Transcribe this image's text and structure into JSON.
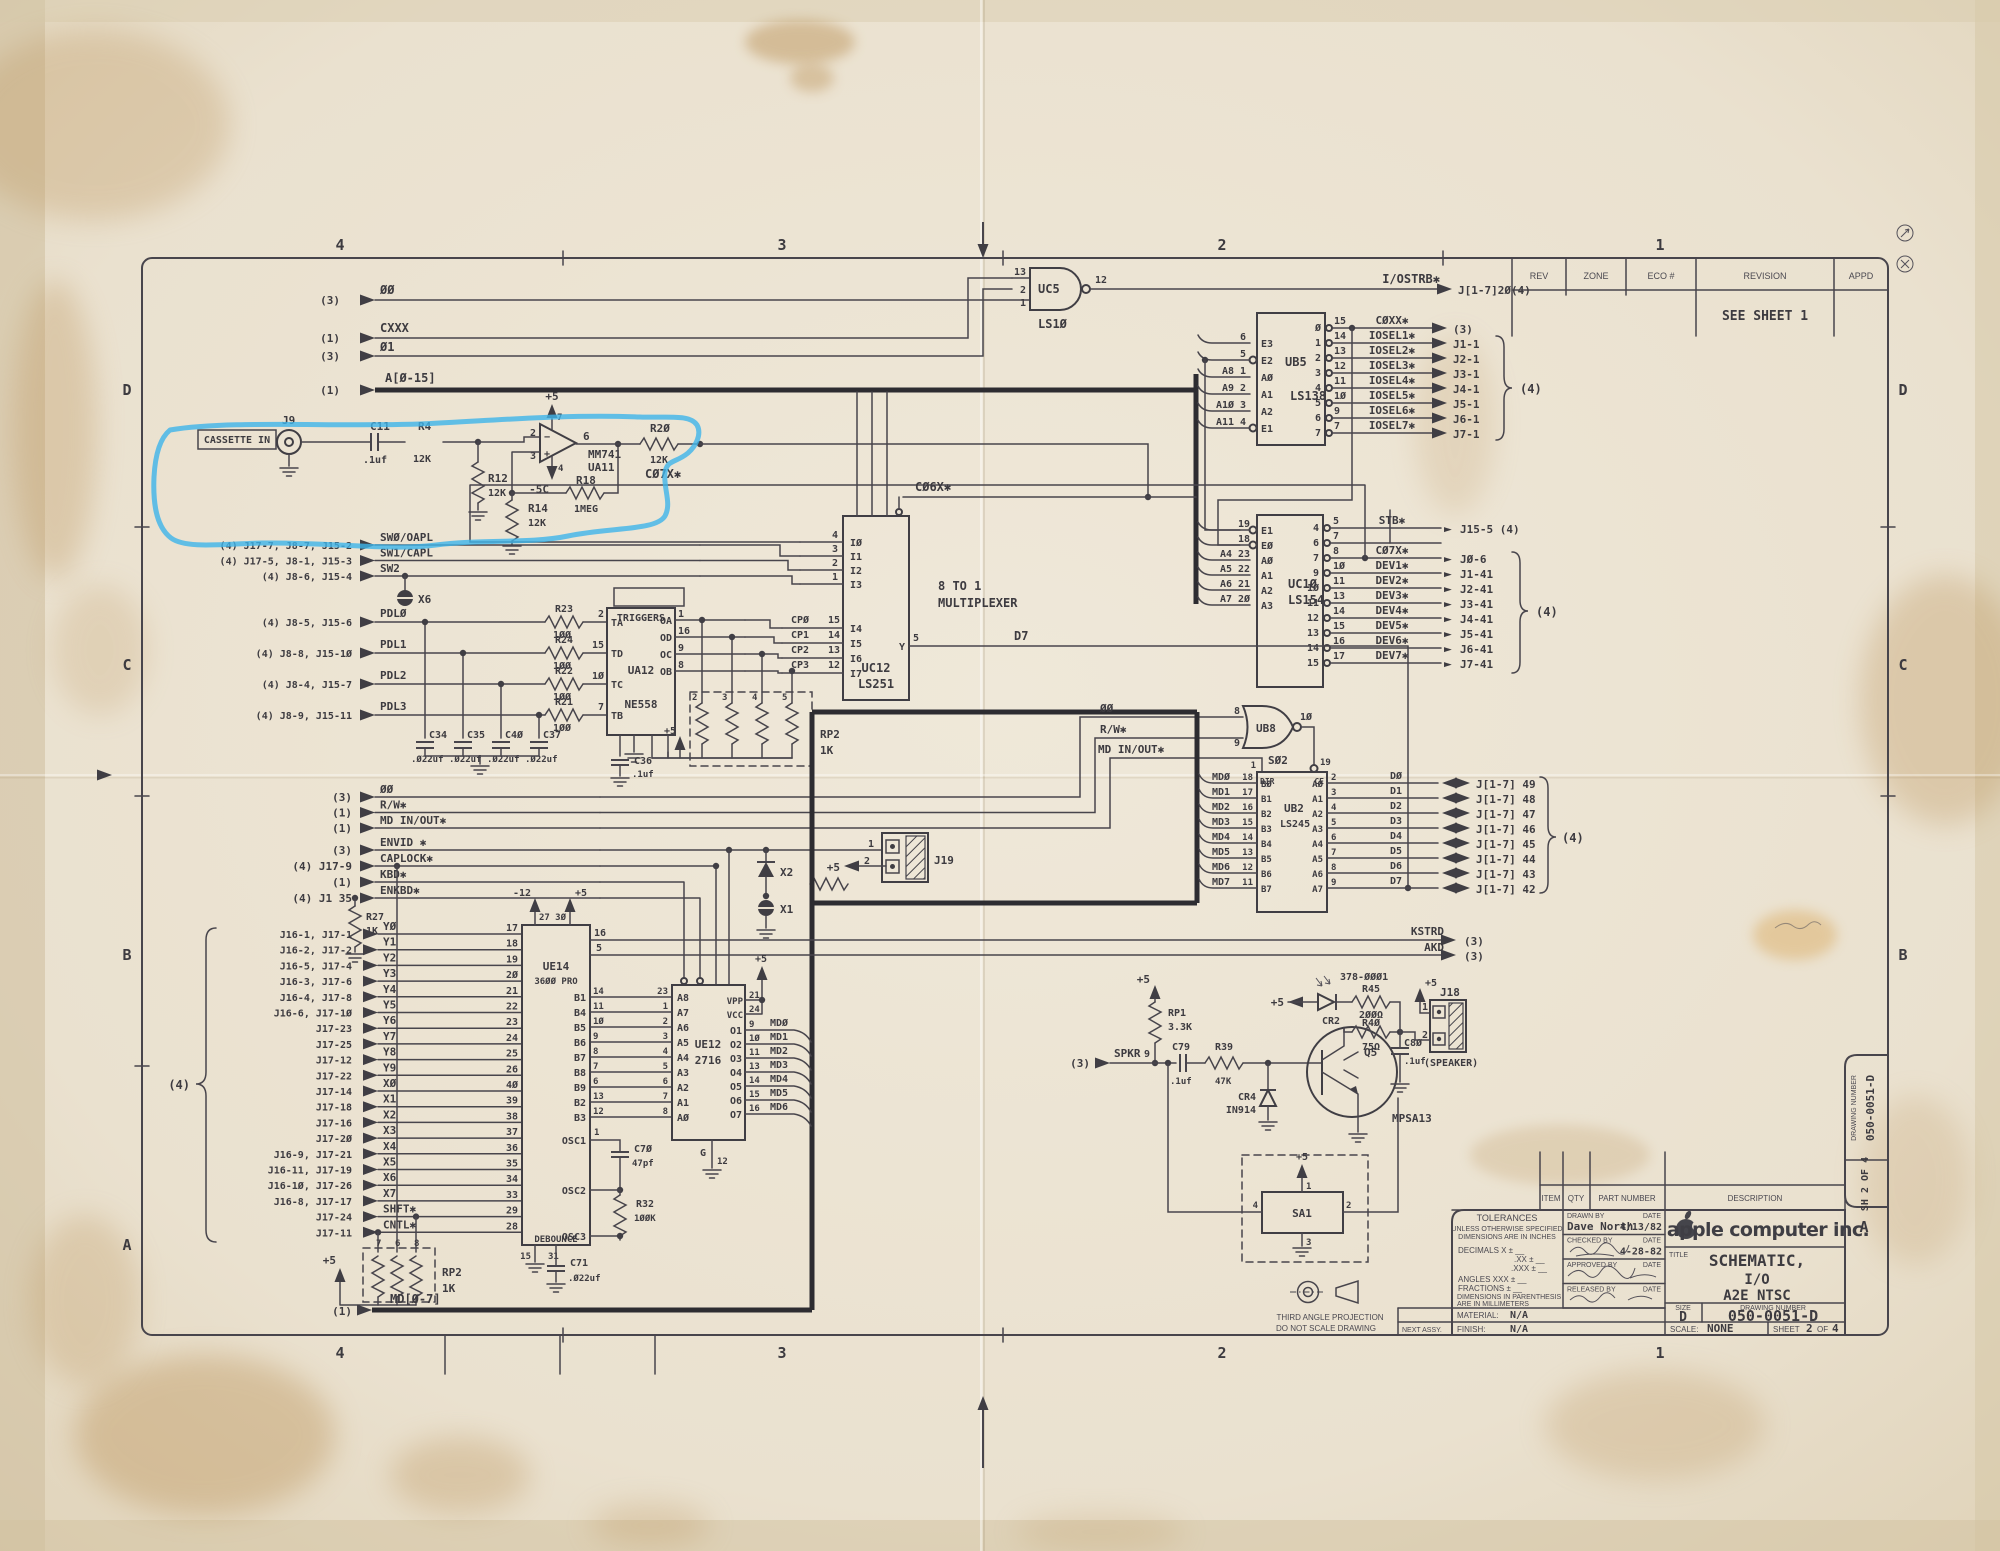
{
  "frame": {
    "zones_top": [
      "4",
      "3",
      "2",
      "1"
    ],
    "zones_bottom": [
      "4",
      "3",
      "2",
      "1"
    ],
    "zones_left": [
      "D",
      "C",
      "B",
      "A"
    ],
    "zones_right": [
      "D",
      "C",
      "B"
    ],
    "zone_a_right": "A",
    "rev_headers": [
      "REV",
      "ZONE",
      "ECO #",
      "REVISION",
      "APPD"
    ],
    "rev_note": "SEE SHEET 1"
  },
  "tb": {
    "parts": [
      "ITEM",
      "QTY",
      "PART NUMBER",
      "DESCRIPTION"
    ],
    "tol1": "TOLERANCES",
    "tol2": "UNLESS OTHERWISE SPECIFIED",
    "tol3": "DIMENSIONS ARE IN INCHES",
    "tol_r1": "DECIMALS       X ±  __",
    "tol_r2": ".XX ±  __",
    "tol_r3": ".XXX ±  __",
    "tol_r4": "ANGLES     XXX ±  __",
    "tol_r5": "FRACTIONS      ±  __",
    "tol_n1": "DIMENSIONS IN PARENTHESIS",
    "tol_n2": "ARE IN MILLIMETERS",
    "sign": [
      {
        "label": "DRAWN BY",
        "dl": "DATE",
        "name": "Dave North",
        "date": "4/13/82"
      },
      {
        "label": "CHECKED BY",
        "dl": "DATE",
        "name": "",
        "date": "4-28-82"
      },
      {
        "label": "APPROVED BY",
        "dl": "DATE",
        "name": "",
        "date": ""
      },
      {
        "label": "RELEASED BY",
        "dl": "DATE",
        "name": "",
        "date": ""
      }
    ],
    "company": "apple computer inc.",
    "title_label": "TITLE",
    "title1": "SCHEMATIC,",
    "title2": "I/O",
    "title3": "A2E NTSC",
    "size_label": "SIZE",
    "size": "D",
    "dn_label": "DRAWING NUMBER",
    "dn": "050-0051-D",
    "scale_label": "SCALE:",
    "scale": "NONE",
    "sheet_label": "SHEET",
    "sheet_no": "2",
    "of": "OF",
    "sheet_total": "4",
    "material_label": "MATERIAL:",
    "material": "N/A",
    "finish_label": "FINISH:",
    "finish": "N/A",
    "next_assy": "NEXT ASSY.",
    "tab_dn_label": "DRAWING NUMBER",
    "tab_dn": "050-0051-D",
    "tab_sh": "SH 2 OF 4",
    "tap1": "THIRD ANGLE PROJECTION",
    "tap2": "DO NOT SCALE DRAWING"
  },
  "sch": {
    "top_rows": [
      {
        "q": "(3)",
        "n": "ØØ"
      },
      {
        "q": "(1)",
        "n": "CXXX"
      },
      {
        "q": "(3)",
        "n": "Ø1"
      },
      {
        "q": "(1)",
        "n": "A[Ø-15]"
      }
    ],
    "uc5": {
      "p13": "13",
      "p2": "2",
      "p1": "1",
      "p12": "12",
      "ref": "UC5",
      "part": "LS1Ø",
      "sig": "I/OSTRB✱",
      "dest": "J[1-7]2Ø(4)"
    },
    "ub5": {
      "ref": "UB5",
      "part": "LS138",
      "left": [
        {
          "s": "",
          "p": "6",
          "n": "E3"
        },
        {
          "s": "",
          "p": "5",
          "n": "E2"
        },
        {
          "s": "A8",
          "p": "1",
          "n": "AØ"
        },
        {
          "s": "A9",
          "p": "2",
          "n": "A1"
        },
        {
          "s": "A1Ø",
          "p": "3",
          "n": "A2"
        },
        {
          "s": "A11",
          "p": "4",
          "n": "E1"
        }
      ],
      "out": [
        {
          "o": "Ø",
          "p": "15",
          "sig": "CØXX✱",
          "d": "(3)"
        },
        {
          "o": "1",
          "p": "14",
          "sig": "IOSEL1✱",
          "d": "J1-1"
        },
        {
          "o": "2",
          "p": "13",
          "sig": "IOSEL2✱",
          "d": "J2-1"
        },
        {
          "o": "3",
          "p": "12",
          "sig": "IOSEL3✱",
          "d": "J3-1"
        },
        {
          "o": "4",
          "p": "11",
          "sig": "IOSEL4✱",
          "d": "J4-1"
        },
        {
          "o": "5",
          "p": "1Ø",
          "sig": "IOSEL5✱",
          "d": "J5-1"
        },
        {
          "o": "6",
          "p": "9",
          "sig": "IOSEL6✱",
          "d": "J6-1"
        },
        {
          "o": "7",
          "p": "7",
          "sig": "IOSEL7✱",
          "d": "J7-1"
        }
      ],
      "grp": "(4)"
    },
    "uc10": {
      "ref": "UC1Ø",
      "part": "LS154",
      "left": [
        {
          "s": "",
          "p": "19",
          "n": "E1"
        },
        {
          "s": "",
          "p": "18",
          "n": "EØ"
        },
        {
          "s": "A4",
          "p": "23",
          "n": "AØ"
        },
        {
          "s": "A5",
          "p": "22",
          "n": "A1"
        },
        {
          "s": "A6",
          "p": "21",
          "n": "A2"
        },
        {
          "s": "A7",
          "p": "2Ø",
          "n": "A3"
        }
      ],
      "out": [
        {
          "o": "4",
          "p": "5",
          "sig": "STB✱",
          "a": "►",
          "d": "J15-5 (4)"
        },
        {
          "o": "6",
          "p": "7",
          "sig": "",
          "a": "",
          "d": ""
        },
        {
          "o": "7",
          "p": "8",
          "sig": "CØ7X✱",
          "a": "►",
          "d": "JØ-6"
        },
        {
          "o": "9",
          "p": "1Ø",
          "sig": "DEV1✱",
          "a": "►",
          "d": "J1-41"
        },
        {
          "o": "1Ø",
          "p": "11",
          "sig": "DEV2✱",
          "a": "►",
          "d": "J2-41"
        },
        {
          "o": "11",
          "p": "13",
          "sig": "DEV3✱",
          "a": "►",
          "d": "J3-41"
        },
        {
          "o": "12",
          "p": "14",
          "sig": "DEV4✱",
          "a": "►",
          "d": "J4-41"
        },
        {
          "o": "13",
          "p": "15",
          "sig": "DEV5✱",
          "a": "►",
          "d": "J5-41"
        },
        {
          "o": "14",
          "p": "16",
          "sig": "DEV6✱",
          "a": "►",
          "d": "J6-41"
        },
        {
          "o": "15",
          "p": "17",
          "sig": "DEV7✱",
          "a": "►",
          "d": "J7-41"
        }
      ],
      "grp": "(4)"
    },
    "cas": {
      "box": "CASSETTE IN",
      "j9": "J9",
      "c11": "C11",
      "c11v": ".1uf",
      "r4": "R4",
      "r4v": "12K",
      "r12": "R12",
      "r12v": "12K",
      "r14": "R14",
      "r14v": "12K",
      "r18": "R18",
      "r18v": "1MEG",
      "r20": "R2Ø",
      "r20v": "12K",
      "p2": "2",
      "p3": "3",
      "p7": "7",
      "p4": "4",
      "p6": "6",
      "minus": "−",
      "plus": "+",
      "amp": "MM741",
      "ref": "UA11",
      "p5": "+5",
      "m5": "-5C",
      "c07x": "CØ7X✱",
      "c06x": "CØ6X✱"
    },
    "uc12": {
      "ref": "UC12",
      "part": "LS251",
      "t1": "8 TO 1",
      "t2": "MULTIPLEXER",
      "abus": [
        "A2",
        "A1",
        "AØ"
      ],
      "selp": [
        "9",
        "1Ø",
        "11",
        "7"
      ],
      "sel": [
        "S2",
        "S1",
        "SØ",
        "OE"
      ],
      "in1": [
        {
          "p": "4",
          "n": "IØ"
        },
        {
          "p": "3",
          "n": "I1"
        },
        {
          "p": "2",
          "n": "I2"
        },
        {
          "p": "1",
          "n": "I3"
        }
      ],
      "in2": [
        {
          "s": "CPØ",
          "p": "15",
          "n": "I4"
        },
        {
          "s": "CP1",
          "p": "14",
          "n": "I5"
        },
        {
          "s": "CP2",
          "p": "13",
          "n": "I6"
        },
        {
          "s": "CP3",
          "p": "12",
          "n": "I7"
        }
      ],
      "y": "Y",
      "yp": "5",
      "ysig": "D7"
    },
    "sw": [
      {
        "l": "(4) J17-7, J8-7, J15-2",
        "n": "SWØ/OAPL"
      },
      {
        "l": "(4) J17-5, J8-1, J15-3",
        "n": "SW1/CAPL"
      },
      {
        "l": "(4) J8-6, J15-4",
        "n": "SW2"
      }
    ],
    "pdl": [
      {
        "l": "(4) J8-5, J15-6",
        "n": "PDLØ",
        "r": "R23",
        "rv": "1ØØ",
        "tp": "2",
        "t": "TA"
      },
      {
        "l": "(4) J8-8, J15-1Ø",
        "n": "PDL1",
        "r": "R24",
        "rv": "1ØØ",
        "tp": "15",
        "t": "TD"
      },
      {
        "l": "(4) J8-4, J15-7",
        "n": "PDL2",
        "r": "R22",
        "rv": "1ØØ",
        "tp": "1Ø",
        "t": "TC"
      },
      {
        "l": "(4) J8-9, J15-11",
        "n": "PDL3",
        "r": "R21",
        "rv": "1ØØ",
        "tp": "7",
        "t": "TB"
      }
    ],
    "x6": "X6",
    "caps": [
      {
        "r": "C34",
        "v": ".Ø22uf"
      },
      {
        "r": "C35",
        "v": ".Ø22uf"
      },
      {
        "r": "C4Ø",
        "v": ".Ø22uf"
      },
      {
        "r": "C37",
        "v": ".Ø22uf"
      }
    ],
    "ua12": {
      "ref": "UA12",
      "part": "NE558",
      "trig": "TRIGGERS",
      "trigp": [
        "3",
        "6",
        "11",
        "14"
      ],
      "outs": [
        {
          "n": "OA",
          "p": "1"
        },
        {
          "n": "OD",
          "p": "16"
        },
        {
          "n": "OC",
          "p": "9"
        },
        {
          "n": "OB",
          "p": "8"
        }
      ],
      "botn": [
        "CV",
        "GND",
        "VCC",
        "R"
      ],
      "botp": [
        "4",
        "12",
        "5",
        "13"
      ],
      "c36": "C36",
      "c36v": ".1uf",
      "p5": "+5"
    },
    "rp2a": {
      "ref": "RP2",
      "v": "1K",
      "pins": [
        "2",
        "3",
        "4",
        "5"
      ]
    },
    "mid_a": [
      {
        "l": "(3)",
        "n": "ØØ"
      },
      {
        "l": "(1)",
        "n": "R/W✱"
      },
      {
        "l": "(1)",
        "n": "MD IN/OUT✱"
      }
    ],
    "mid_b": [
      {
        "l": "(3)",
        "n": "ENVID ✱"
      },
      {
        "l": "(4) J17-9",
        "n": "CAPLOCK✱"
      },
      {
        "l": "(1)",
        "n": "KBD✱"
      },
      {
        "l": "(4) J1 35",
        "n": "ENKBD✱"
      }
    ],
    "r27": {
      "r": "R27",
      "v": "1K"
    },
    "kbd": [
      {
        "l": "J16-1, J17-1",
        "n": "YØ",
        "p": "17"
      },
      {
        "l": "J16-2, J17-2",
        "n": "Y1",
        "p": "18"
      },
      {
        "l": "J16-5, J17-4",
        "n": "Y2",
        "p": "19"
      },
      {
        "l": "J16-3, J17-6",
        "n": "Y3",
        "p": "2Ø"
      },
      {
        "l": "J16-4, J17-8",
        "n": "Y4",
        "p": "21"
      },
      {
        "l": "J16-6, J17-1Ø",
        "n": "Y5",
        "p": "22"
      },
      {
        "l": "J17-23",
        "n": "Y6",
        "p": "23"
      },
      {
        "l": "J17-25",
        "n": "Y7",
        "p": "24"
      },
      {
        "l": "J17-12",
        "n": "Y8",
        "p": "25"
      },
      {
        "l": "J17-22",
        "n": "Y9",
        "p": "26"
      },
      {
        "l": "J17-14",
        "n": "XØ",
        "p": "4Ø"
      },
      {
        "l": "J17-18",
        "n": "X1",
        "p": "39"
      },
      {
        "l": "J17-16",
        "n": "X2",
        "p": "38"
      },
      {
        "l": "J17-2Ø",
        "n": "X3",
        "p": "37"
      },
      {
        "l": "J16-9, J17-21",
        "n": "X4",
        "p": "36"
      },
      {
        "l": "J16-11, J17-19",
        "n": "X5",
        "p": "35"
      },
      {
        "l": "J16-1Ø, J17-26",
        "n": "X6",
        "p": "34"
      },
      {
        "l": "J16-8, J17-17",
        "n": "X7",
        "p": "33"
      },
      {
        "l": "J17-24",
        "n": "SHFT✱",
        "p": "29"
      },
      {
        "l": "J17-11",
        "n": "CNTL✱",
        "p": "28"
      }
    ],
    "kbd_grp": "(4)",
    "rp2b": {
      "ref": "RP2",
      "v": "1K",
      "pins": [
        "7",
        "6",
        "8"
      ],
      "p5": "+5"
    },
    "md_bus": {
      "q": "(1)",
      "n": "MD[Ø-7]"
    },
    "ue14": {
      "ref": "UE14",
      "part": "36ØØ PRO",
      "m12": "-12",
      "m12p": "27",
      "p5": "+5",
      "p5p": "3Ø",
      "k1": "16",
      "k2": "5",
      "b": [
        {
          "b": "B1",
          "bp": "14",
          "ap": "23",
          "an": "A8"
        },
        {
          "b": "B4",
          "bp": "11",
          "ap": "1",
          "an": "A7"
        },
        {
          "b": "B5",
          "bp": "1Ø",
          "ap": "2",
          "an": "A6"
        },
        {
          "b": "B6",
          "bp": "9",
          "ap": "3",
          "an": "A5"
        },
        {
          "b": "B7",
          "bp": "8",
          "ap": "4",
          "an": "A4"
        },
        {
          "b": "B8",
          "bp": "7",
          "ap": "5",
          "an": "A3"
        },
        {
          "b": "B9",
          "bp": "6",
          "ap": "6",
          "an": "A2"
        },
        {
          "b": "B2",
          "bp": "13",
          "ap": "7",
          "an": "A1"
        },
        {
          "b": "B3",
          "bp": "12",
          "ap": "8",
          "an": "AØ"
        }
      ],
      "osc1": "OSC1",
      "osc1p": "1",
      "osc2": "OSC2",
      "osc3": "OSC3",
      "deb": "DEBOUNCE",
      "debp1": "15",
      "debp2": "31",
      "c70": "C7Ø",
      "c70v": "47pf",
      "r32": "R32",
      "r32v": "1ØØK",
      "c71": "C71",
      "c71v": ".Ø22uf"
    },
    "ue12": {
      "ref": "UE12",
      "part": "2716",
      "topp": [
        "18",
        "2Ø",
        "22",
        "19"
      ],
      "topn": [
        "CE",
        "OE",
        "A9",
        "A1Ø"
      ],
      "vpp": "VPP",
      "vppp": "21",
      "vcc": "VCC",
      "vccp": "24",
      "p5": "+5",
      "g": "G",
      "gp": "12",
      "o": [
        {
          "n": "O1",
          "p": "9",
          "s": "MDØ"
        },
        {
          "n": "O2",
          "p": "1Ø",
          "s": "MD1"
        },
        {
          "n": "O3",
          "p": "11",
          "s": "MD2"
        },
        {
          "n": "O4",
          "p": "13",
          "s": "MD3"
        },
        {
          "n": "O5",
          "p": "14",
          "s": "MD4"
        },
        {
          "n": "O6",
          "p": "15",
          "s": "MD5"
        },
        {
          "n": "O7",
          "p": "16",
          "s": "MD6"
        }
      ]
    },
    "x1": "X1",
    "x2": "X2",
    "j19": {
      "ref": "J19",
      "p1": "1",
      "p2": "2",
      "p5": "+5"
    },
    "ub8": {
      "ref": "UB8",
      "part": "SØ2",
      "p8": "8",
      "p9": "9",
      "p10": "1Ø",
      "in1": "ØØ",
      "in2": "R/W✱",
      "in3": "MD IN/OUT✱",
      "dirp": "1",
      "dir": "DIR",
      "ce": "CE",
      "cep": "19"
    },
    "ub2": {
      "ref": "UB2",
      "part": "LS245",
      "rows": [
        {
          "ms": "MDØ",
          "mp": "18",
          "bn": "BØ",
          "an": "AØ",
          "ap": "2",
          "ds": "DØ",
          "d": "J[1-7] 49"
        },
        {
          "ms": "MD1",
          "mp": "17",
          "bn": "B1",
          "an": "A1",
          "ap": "3",
          "ds": "D1",
          "d": "J[1-7] 48"
        },
        {
          "ms": "MD2",
          "mp": "16",
          "bn": "B2",
          "an": "A2",
          "ap": "4",
          "ds": "D2",
          "d": "J[1-7] 47"
        },
        {
          "ms": "MD3",
          "mp": "15",
          "bn": "B3",
          "an": "A3",
          "ap": "5",
          "ds": "D3",
          "d": "J[1-7] 46"
        },
        {
          "ms": "MD4",
          "mp": "14",
          "bn": "B4",
          "an": "A4",
          "ap": "6",
          "ds": "D4",
          "d": "J[1-7] 45"
        },
        {
          "ms": "MD5",
          "mp": "13",
          "bn": "B5",
          "an": "A5",
          "ap": "7",
          "ds": "D5",
          "d": "J[1-7] 44"
        },
        {
          "ms": "MD6",
          "mp": "12",
          "bn": "B6",
          "an": "A6",
          "ap": "8",
          "ds": "D6",
          "d": "J[1-7] 43"
        },
        {
          "ms": "MD7",
          "mp": "11",
          "bn": "B7",
          "an": "A7",
          "ap": "9",
          "ds": "D7",
          "d": "J[1-7] 42"
        }
      ],
      "grp": "(4)"
    },
    "kstrd": {
      "n": "KSTRD",
      "d": "(3)"
    },
    "akd": {
      "n": "AKD",
      "d": "(3)"
    },
    "spk": {
      "l": "(3)",
      "n": "SPKR",
      "rp1": "RP1",
      "rp1v": "3.3K",
      "rp1p": "9",
      "p5": "+5",
      "c79": "C79",
      "c79v": ".1uf",
      "r39": "R39",
      "r39v": "47K",
      "cr4": "CR4",
      "cr4v": "IN914",
      "q": "Q5",
      "qv": "MPSA13",
      "cr2": "CR2",
      "led": "378-ØØØ1",
      "r45": "R45",
      "r45v": "2ØØΩ",
      "r40": "R4Ø",
      "r40v": "75Ω",
      "c80": "C8Ø",
      "c80v": ".1uf",
      "j18": "J18",
      "j18p1": "1",
      "j18p2": "2",
      "j18l": "(SPEAKER)"
    },
    "sa1": {
      "ref": "SA1",
      "p1": "1",
      "p2": "2",
      "p3": "3",
      "p4": "4",
      "p5": "+5"
    }
  }
}
